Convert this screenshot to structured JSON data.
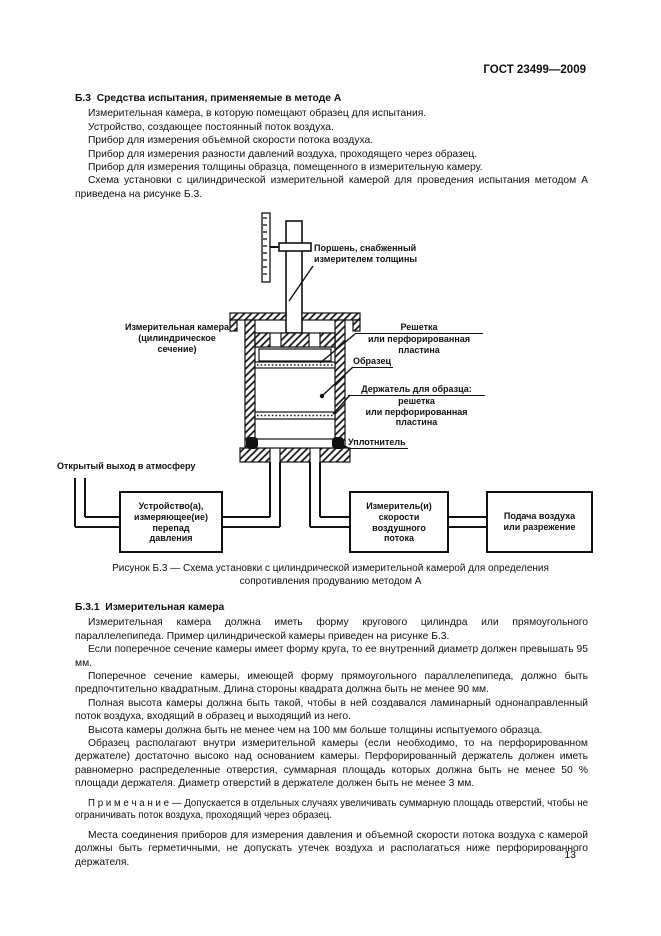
{
  "colors": {
    "ink": "#111111",
    "paper": "#ffffff"
  },
  "page": {
    "header": "ГОСТ 23499—2009",
    "page_number": "13"
  },
  "section_b3": {
    "heading": "Б.3  Средства испытания, применяемые в методе А",
    "paragraphs": [
      "Измерительная камера, в которую помещают образец для испытания.",
      "Устройство, создающее постоянный поток воздуха.",
      "Прибор для измерения объемной скорости потока воздуха.",
      "Прибор для измерения разности давлений воздуха, проходящего через образец.",
      "Прибор для измерения толщины образца, помещенного в измерительную камеру.",
      "Схема установки с цилиндрической измерительной камерой для проведения испытания методом А приведена на рисунке Б.3."
    ]
  },
  "figure": {
    "labels": {
      "piston_lines": [
        "Поршень, снабженный",
        "измерителем толщины"
      ],
      "chamber_lines": [
        "Измерительная камера",
        "(цилиндрическое",
        "сечение)"
      ],
      "grid": {
        "line1": "Решетка",
        "rest": [
          "или перфорированная",
          "пластина"
        ]
      },
      "sample": "Образец",
      "holder": {
        "line1": "Держатель для образца:",
        "rest": [
          "решетка",
          "или перфорированная",
          "пластина"
        ]
      },
      "seal": "Уплотнитель",
      "outlet": "Открытый выход в атмосферу",
      "box1_lines": [
        "Устройство(а),",
        "измеряющее(ие)",
        "перепад",
        "давления"
      ],
      "box2_lines": [
        "Измеритель(и)",
        "скорости",
        "воздушного",
        "потока"
      ],
      "box3_lines": [
        "Подача воздуха",
        "или разрежение"
      ]
    },
    "caption_lines": [
      "Рисунок Б.3 — Схема установки с цилиндрической измерительной камерой для определения",
      "сопротивления продуванию методом А"
    ]
  },
  "section_b31": {
    "heading": "Б.3.1  Измерительная камера",
    "paragraphs": [
      "Измерительная камера должна иметь форму кругового цилиндра или прямоугольного параллелепипеда. Пример цилиндрической камеры приведен на рисунке Б.3.",
      "Если поперечное сечение камеры имеет форму круга, то ее внутренний диаметр должен превышать 95 мм.",
      "Поперечное сечение камеры, имеющей форму прямоугольного параллелепипеда, должно быть предпочтительно квадратным. Длина стороны квадрата должна быть не менее 90 мм.",
      "Полная высота камеры должна быть такой, чтобы в ней создавался ламинарный однонаправленный поток воздуха, входящий в образец и выходящий из него.",
      "Высота камеры должна быть не менее чем на 100 мм больше толщины испытуемого образца.",
      "Образец располагают внутри измерительной камеры (если необходимо, то на перфорированном держателе) достаточно высоко над основанием камеры. Перфорированный держатель должен иметь равномерно распределенные отверстия, суммарная площадь которых должна быть не менее 50 % площади держателя. Диаметр отверстий в держателе должен быть не менее 3 мм."
    ],
    "note": "П р и м е ч а н и е — Допускается в отдельных случаях увеличивать суммарную площадь отверстий, чтобы не ограничивать поток воздуха, проходящий через образец.",
    "final_paragraph": "Места соединения приборов для измерения давления и объемной скорости потока воздуха с камерой должны быть герметичными, не допускать утечек воздуха и располагаться ниже перфорированного держателя."
  }
}
